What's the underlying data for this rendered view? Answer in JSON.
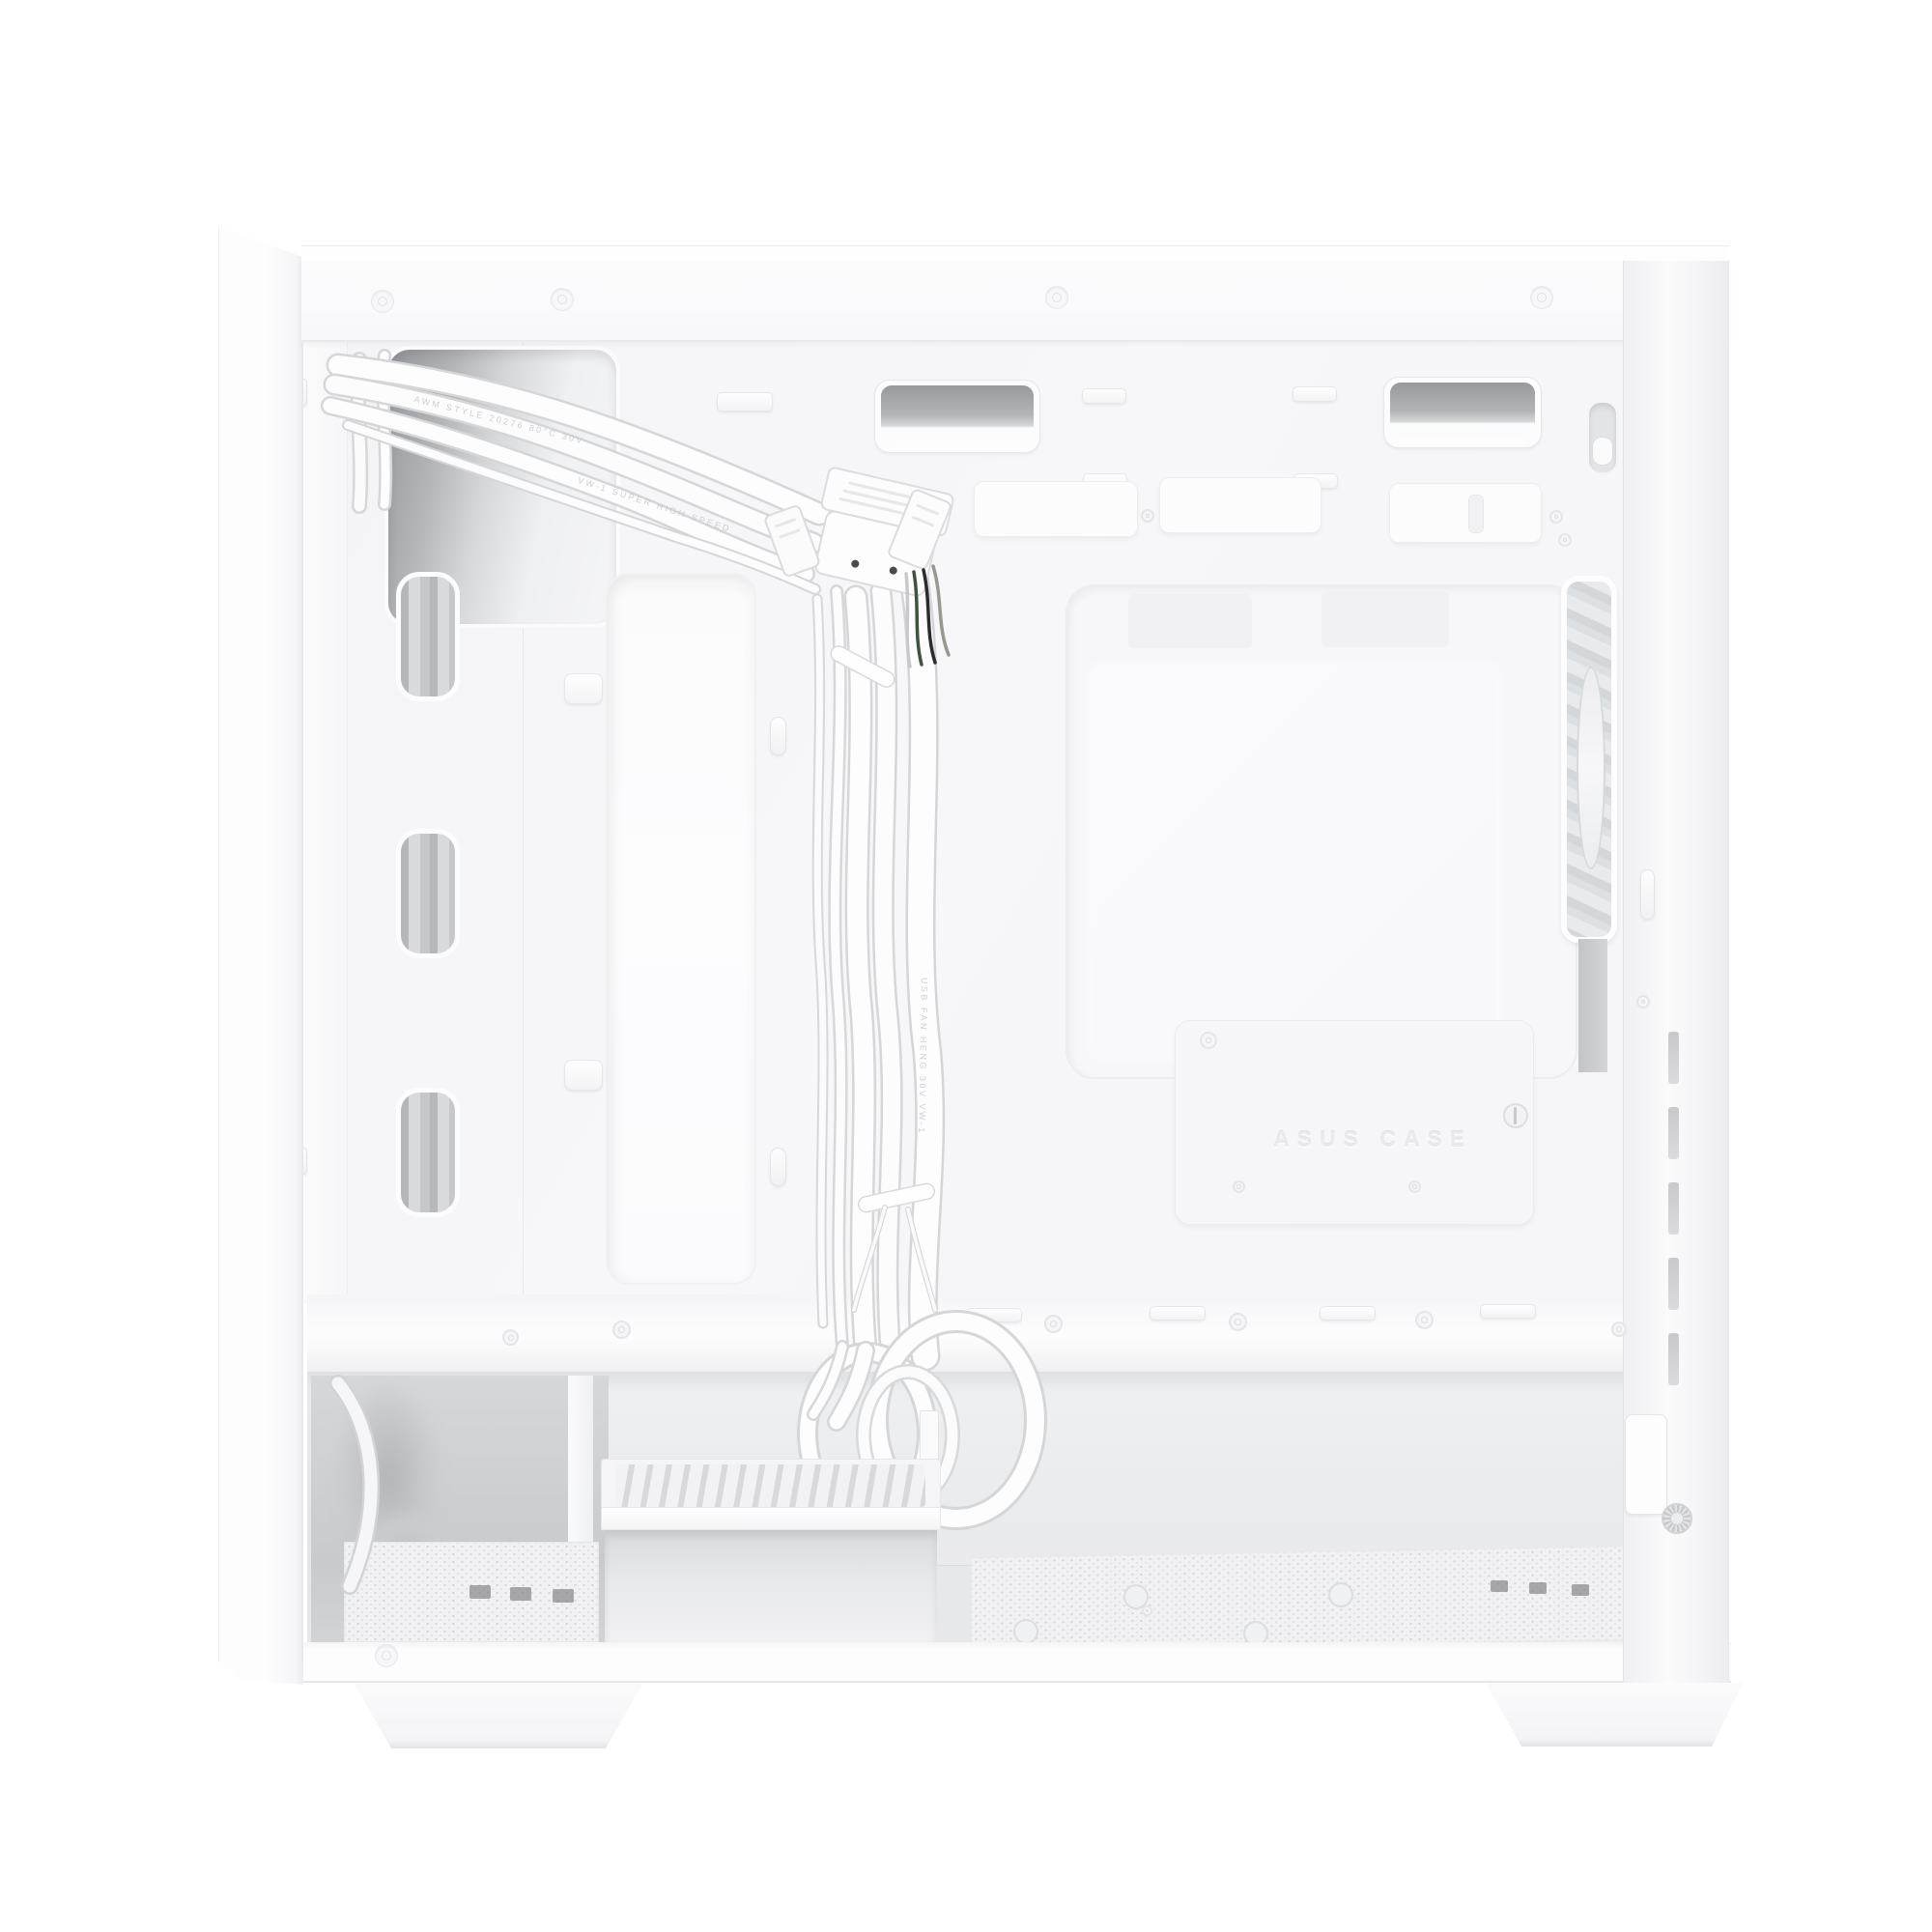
{
  "meta": {
    "description": "Product photograph of a white compact PC tower case, side panel removed, showing motherboard tray cutouts, pre-routed white front-panel cable bundle, rear exhaust fan and bottom drive cage",
    "background": "#ffffff"
  },
  "embossed_label": "ASUS CASE",
  "cable_print": {
    "line1": "AWM STYLE 20276 80°C 30V",
    "line2": "VW-1 SUPER HIGH SPEED",
    "line3": "USB FAN HENG 30V VW-1"
  },
  "colors": {
    "case_white": "#fdfdfe",
    "panel_tint": "#f6f6f8",
    "outline_gray": "#e7e8ea",
    "grommet_gray": "#9a9b9d",
    "fan_gray": "#dcdde0",
    "slot_dark": "#6f7072"
  }
}
